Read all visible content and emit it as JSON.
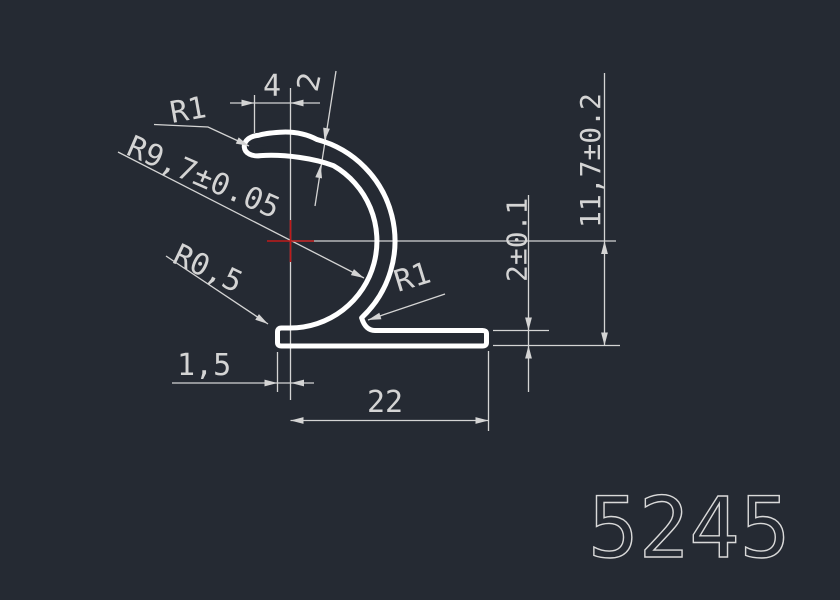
{
  "drawing": {
    "part_number": "5245",
    "dimensions": {
      "top_width": "4",
      "lip_wall_thickness": "2",
      "lip_tip_radius": "R1",
      "main_radius": "R9,7±0.05",
      "flange_end_radius": "R0,5",
      "flange_left_offset": "1,5",
      "flange_length": "22",
      "inner_corner_radius": "R1",
      "flange_thickness": "2±0.1",
      "overall_height": "11,7±0.2"
    },
    "colors": {
      "background": "#252a33",
      "profile_line": "#ffffff",
      "dimension_line": "#d4d4d4",
      "center_mark": "#c01a1a",
      "part_number": "#d9d9d9"
    }
  }
}
